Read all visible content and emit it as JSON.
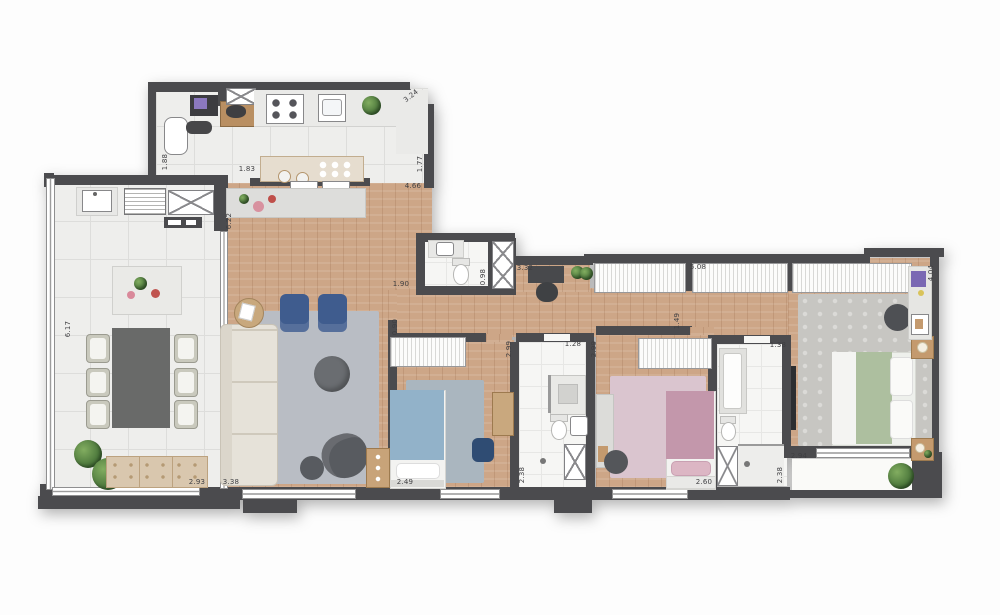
{
  "document": {
    "kind": "apartment-floor-plan",
    "visible_text_type": "dimension-labels-only"
  },
  "colors": {
    "wall": "#4b4b4e",
    "wood": "#cda687",
    "tile": "#eeeeec",
    "bath_floor": "#f6f6f4",
    "rug_living": "#b9bdc4",
    "rug_bedroom1": "#aab6bf",
    "rug_bedroom2": "#dac5cf",
    "rug_master": "#c7c6c2",
    "sofa": "#e6e2d9",
    "armchair_blue": "#3f5c8e",
    "bed_blue": "#92b2c9",
    "bed_pink": "#c397ab",
    "bed_green": "#adbf9f",
    "table_dark": "#696a69",
    "plant_green": "#4e7d3c"
  },
  "dimensions": [
    {
      "t": "3.24",
      "x": 411,
      "y": 96,
      "r": -38
    },
    {
      "t": "1.77",
      "x": 420,
      "y": 164,
      "r": -90
    },
    {
      "t": "1.88",
      "x": 165,
      "y": 162,
      "r": -90
    },
    {
      "t": "1.83",
      "x": 247,
      "y": 169,
      "r": 0
    },
    {
      "t": "4.66",
      "x": 413,
      "y": 186,
      "r": 0
    },
    {
      "t": "6.22",
      "x": 229,
      "y": 221,
      "r": -90
    },
    {
      "t": "6.17",
      "x": 68,
      "y": 329,
      "r": -90
    },
    {
      "t": "2.93",
      "x": 197,
      "y": 482,
      "r": 0
    },
    {
      "t": "3.38",
      "x": 231,
      "y": 482,
      "r": 0
    },
    {
      "t": "1.90",
      "x": 401,
      "y": 284,
      "r": 0
    },
    {
      "t": "0.98",
      "x": 483,
      "y": 277,
      "r": -90
    },
    {
      "t": "0.90",
      "x": 395,
      "y": 327,
      "r": -90
    },
    {
      "t": "3.32",
      "x": 525,
      "y": 268,
      "r": 0
    },
    {
      "t": "5.08",
      "x": 698,
      "y": 267,
      "r": 0
    },
    {
      "t": "1.49",
      "x": 677,
      "y": 321,
      "r": -90
    },
    {
      "t": "2.99",
      "x": 509,
      "y": 349,
      "r": -90
    },
    {
      "t": "1.28",
      "x": 573,
      "y": 344,
      "r": 0
    },
    {
      "t": "2.99",
      "x": 594,
      "y": 349,
      "r": -90
    },
    {
      "t": "1.38",
      "x": 778,
      "y": 345,
      "r": 0
    },
    {
      "t": "2.49",
      "x": 405,
      "y": 482,
      "r": 0
    },
    {
      "t": "2.38",
      "x": 522,
      "y": 475,
      "r": -90
    },
    {
      "t": "2.60",
      "x": 704,
      "y": 482,
      "r": 0
    },
    {
      "t": "2.38",
      "x": 780,
      "y": 475,
      "r": -90
    },
    {
      "t": "2.94",
      "x": 799,
      "y": 456,
      "r": 0
    },
    {
      "t": "4.04",
      "x": 931,
      "y": 273,
      "r": -90
    }
  ]
}
